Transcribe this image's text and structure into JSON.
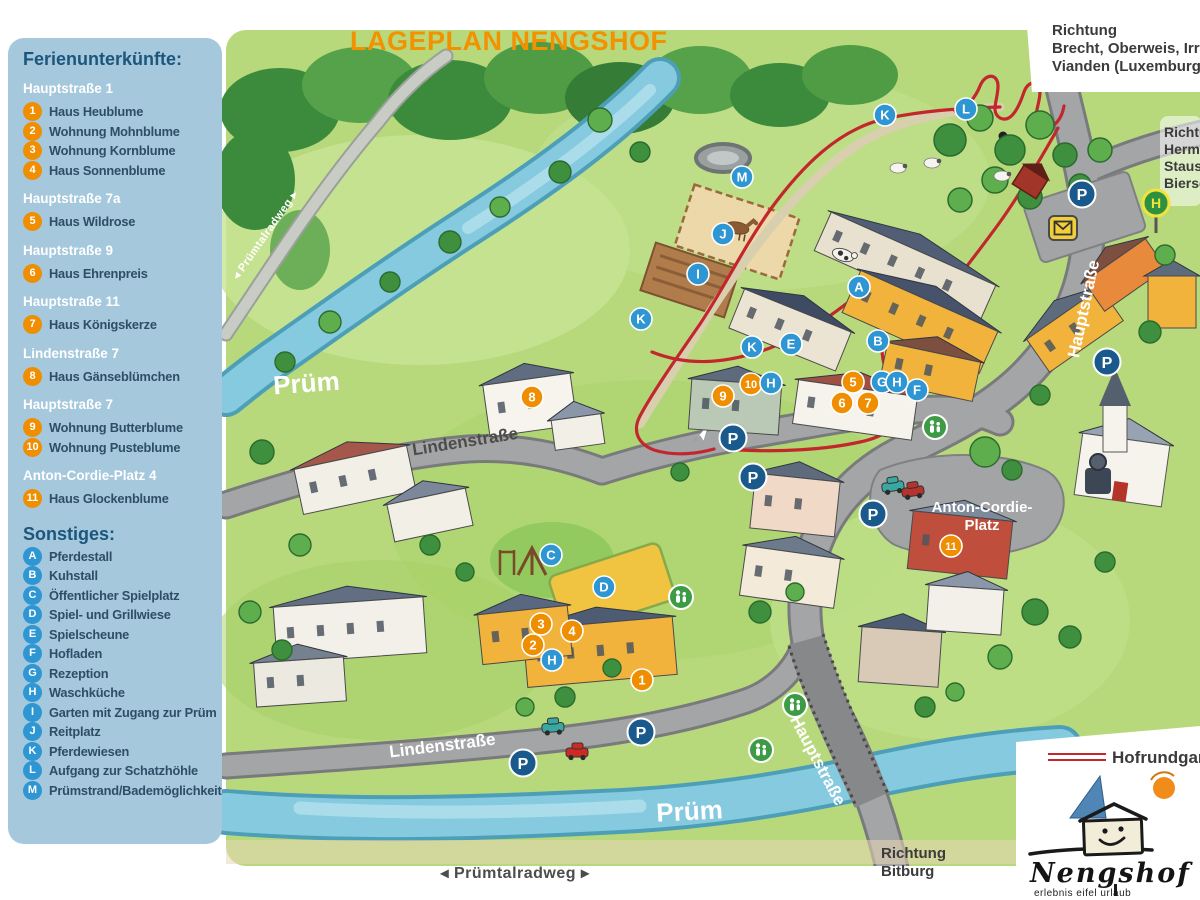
{
  "page": {
    "title": "LAGEPLAN NENGSHOF"
  },
  "sidebar": {
    "heading_accommodations": "Ferienunterkünfte:",
    "groups": [
      {
        "address": "Hauptstraße 1",
        "items": [
          {
            "id": "1",
            "label": "Haus Heublume"
          },
          {
            "id": "2",
            "label": "Wohnung Mohnblume"
          },
          {
            "id": "3",
            "label": "Wohnung Kornblume"
          },
          {
            "id": "4",
            "label": "Haus Sonnenblume"
          }
        ]
      },
      {
        "address": "Hauptstraße 7a",
        "items": [
          {
            "id": "5",
            "label": "Haus Wildrose"
          }
        ]
      },
      {
        "address": "Hauptstraße 9",
        "items": [
          {
            "id": "6",
            "label": "Haus Ehrenpreis"
          }
        ]
      },
      {
        "address": "Hauptstraße 11",
        "items": [
          {
            "id": "7",
            "label": "Haus Königskerze"
          }
        ]
      },
      {
        "address": "Lindenstraße 7",
        "items": [
          {
            "id": "8",
            "label": "Haus Gänseblümchen"
          }
        ]
      },
      {
        "address": "Hauptstraße 7",
        "items": [
          {
            "id": "9",
            "label": "Wohnung Butterblume"
          },
          {
            "id": "10",
            "label": "Wohnung Pusteblume"
          }
        ]
      },
      {
        "address": "Anton-Cordie-Platz 4",
        "items": [
          {
            "id": "11",
            "label": "Haus Glockenblume"
          }
        ]
      }
    ],
    "heading_others": "Sonstiges:",
    "others": [
      {
        "id": "A",
        "label": "Pferdestall"
      },
      {
        "id": "B",
        "label": "Kuhstall"
      },
      {
        "id": "C",
        "label": "Öffentlicher Spielplatz"
      },
      {
        "id": "D",
        "label": "Spiel- und Grillwiese"
      },
      {
        "id": "E",
        "label": "Spielscheune"
      },
      {
        "id": "F",
        "label": "Hofladen"
      },
      {
        "id": "G",
        "label": "Rezeption"
      },
      {
        "id": "H",
        "label": "Waschküche"
      },
      {
        "id": "I",
        "label": "Garten mit Zugang zur Prüm"
      },
      {
        "id": "J",
        "label": "Reitplatz"
      },
      {
        "id": "K",
        "label": "Pferdewiesen"
      },
      {
        "id": "L",
        "label": "Aufgang zur Schatzhöhle"
      },
      {
        "id": "M",
        "label": "Prümstrand/Bademöglichkeit"
      }
    ]
  },
  "directions": {
    "top_right": [
      "Richtung",
      "Brecht, Oberweis, Irrel,",
      "Vianden (Luxemburg)"
    ],
    "right_edge": [
      "Richtung",
      "Hermesdorf,",
      "Stausee",
      "Biersdorf"
    ],
    "bottom": [
      "Richtung",
      "Bitburg"
    ],
    "bike_path_bottom": "◂ Prümtalradweg ▸"
  },
  "map_labels": [
    {
      "text": "Prüm",
      "x": 307,
      "y": 392,
      "rot": -4,
      "cls": "river"
    },
    {
      "text": "Prüm",
      "x": 690,
      "y": 820,
      "rot": -3,
      "cls": "river"
    },
    {
      "text": "Lindenstraße",
      "x": 466,
      "y": 447,
      "rot": -9,
      "cls": "street-dark"
    },
    {
      "text": "Lindenstraße",
      "x": 443,
      "y": 751,
      "rot": -7,
      "cls": "street-white"
    },
    {
      "text": "Hauptstraße",
      "x": 1089,
      "y": 310,
      "rot": -78,
      "cls": "street-white"
    },
    {
      "text": "Hauptstraße",
      "x": 813,
      "y": 763,
      "rot": 62,
      "cls": "street-white"
    },
    {
      "text": "Anton-Cordie-",
      "x": 982,
      "y": 512,
      "rot": 0,
      "cls": "place"
    },
    {
      "text": "Platz",
      "x": 982,
      "y": 530,
      "rot": 0,
      "cls": "place"
    },
    {
      "text": "◂ Prümtalradweg ▸",
      "x": 268,
      "y": 237,
      "rot": -55,
      "cls": "path-small"
    }
  ],
  "markers": {
    "numbers": [
      {
        "id": "1",
        "x": 642,
        "y": 680
      },
      {
        "id": "2",
        "x": 533,
        "y": 645
      },
      {
        "id": "3",
        "x": 541,
        "y": 624
      },
      {
        "id": "4",
        "x": 572,
        "y": 631
      },
      {
        "id": "5",
        "x": 853,
        "y": 382
      },
      {
        "id": "6",
        "x": 842,
        "y": 403
      },
      {
        "id": "7",
        "x": 868,
        "y": 403
      },
      {
        "id": "8",
        "x": 532,
        "y": 397
      },
      {
        "id": "9",
        "x": 723,
        "y": 396
      },
      {
        "id": "10",
        "x": 751,
        "y": 384
      },
      {
        "id": "11",
        "x": 951,
        "y": 546
      }
    ],
    "letters": [
      {
        "id": "A",
        "x": 859,
        "y": 287
      },
      {
        "id": "B",
        "x": 878,
        "y": 341
      },
      {
        "id": "C",
        "x": 551,
        "y": 555
      },
      {
        "id": "D",
        "x": 604,
        "y": 587
      },
      {
        "id": "E",
        "x": 791,
        "y": 344
      },
      {
        "id": "F",
        "x": 917,
        "y": 390
      },
      {
        "id": "G",
        "x": 882,
        "y": 382
      },
      {
        "id": "H",
        "x": 897,
        "y": 382
      },
      {
        "id": "H",
        "x": 771,
        "y": 383
      },
      {
        "id": "H",
        "x": 552,
        "y": 660
      },
      {
        "id": "I",
        "x": 698,
        "y": 274
      },
      {
        "id": "J",
        "x": 723,
        "y": 234
      },
      {
        "id": "K",
        "x": 885,
        "y": 115
      },
      {
        "id": "K",
        "x": 641,
        "y": 319
      },
      {
        "id": "K",
        "x": 752,
        "y": 347
      },
      {
        "id": "L",
        "x": 966,
        "y": 109
      },
      {
        "id": "M",
        "x": 742,
        "y": 177
      }
    ],
    "parking": [
      {
        "x": 733,
        "y": 438
      },
      {
        "x": 753,
        "y": 477
      },
      {
        "x": 873,
        "y": 514
      },
      {
        "x": 641,
        "y": 732
      },
      {
        "x": 523,
        "y": 763
      },
      {
        "x": 1082,
        "y": 194
      },
      {
        "x": 1107,
        "y": 362
      }
    ],
    "pedestrian_signs": [
      {
        "x": 935,
        "y": 427
      },
      {
        "x": 681,
        "y": 597
      },
      {
        "x": 795,
        "y": 705
      },
      {
        "x": 761,
        "y": 750
      }
    ],
    "bus_stop": {
      "x": 1156,
      "y": 203,
      "label": "H"
    },
    "post_box": {
      "x": 1063,
      "y": 228
    }
  },
  "legend": {
    "route_label": "Hofrundgang"
  },
  "logo": {
    "name": "Nengshof",
    "tagline": "erlebnis eifel  urlaub"
  },
  "colors": {
    "accent_orange": "#ef8e00",
    "badge_blue": "#2e96d2",
    "parking_blue": "#19598c",
    "pedestrian_green": "#3e9b45",
    "bus_green": "#2e9140",
    "bus_yellow": "#f2e23c",
    "post_yellow": "#f2cf3a",
    "route_red": "#c3272d",
    "title_orange": "#f39200",
    "sidebar_bg": "#a5c8dd",
    "sidebar_heading": "#1c567c",
    "sidebar_text": "#2f4d66",
    "direction_text": "#3b3b3b"
  }
}
